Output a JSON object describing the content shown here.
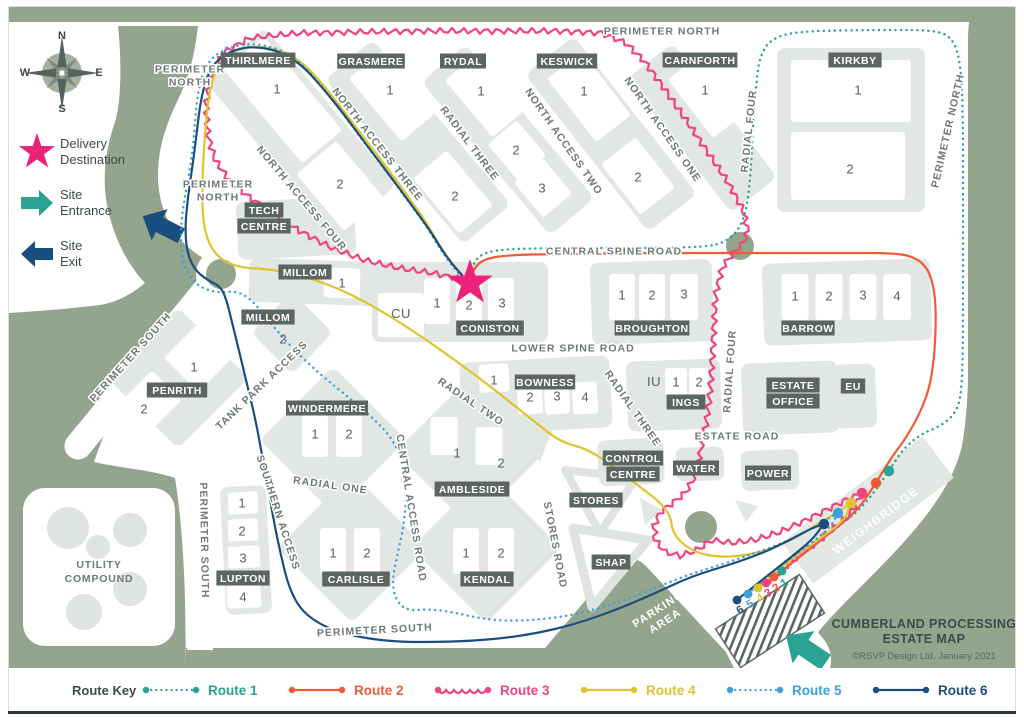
{
  "window": {
    "title_line1": "CUMBERLAND PROCESSING",
    "title_line2": "ESTATE MAP",
    "copyright": "©RSVP Design Ltd.  January 2021"
  },
  "compass": {
    "north": "N",
    "east": "E",
    "south": "S",
    "west": "W"
  },
  "legend": {
    "delivery": {
      "line1": "Delivery",
      "line2": "Destination"
    },
    "entrance": {
      "line1": "Site",
      "line2": "Entrance"
    },
    "exit": {
      "line1": "Site",
      "line2": "Exit"
    }
  },
  "route_key": {
    "title": "Route Key",
    "routes": [
      {
        "id": "route1",
        "label": "Route 1",
        "color": "#29A294",
        "style": "dotted"
      },
      {
        "id": "route2",
        "label": "Route 2",
        "color": "#F05A38",
        "style": "solid"
      },
      {
        "id": "route3",
        "label": "Route 3",
        "color": "#F0437F",
        "style": "wavy"
      },
      {
        "id": "route4",
        "label": "Route 4",
        "color": "#DFC32F",
        "style": "solid"
      },
      {
        "id": "route5",
        "label": "Route 5",
        "color": "#3BA0DC",
        "style": "dotted"
      },
      {
        "id": "route6",
        "label": "Route 6",
        "color": "#1C4E7D",
        "style": "solid"
      }
    ]
  },
  "map": {
    "buildings": {
      "thirlmere": {
        "label": "THIRLMERE",
        "units": [
          "1",
          "2"
        ]
      },
      "grasmere": {
        "label": "GRASMERE",
        "units": [
          "1",
          "2"
        ]
      },
      "rydal": {
        "label": "RYDAL",
        "units": [
          "1",
          "2",
          "3"
        ]
      },
      "keswick": {
        "label": "KESWICK",
        "units": [
          "1",
          "2"
        ]
      },
      "carnforth": {
        "label": "CARNFORTH",
        "units": [
          "1"
        ]
      },
      "kirkby": {
        "label": "KIRKBY",
        "units": [
          "1",
          "2"
        ]
      },
      "tech_centre": {
        "label": "TECH CENTRE",
        "units": []
      },
      "millom_1": {
        "label": "MILLOM",
        "units": [
          "1"
        ]
      },
      "millom_2": {
        "label": "MILLOM",
        "units": [
          "2"
        ]
      },
      "coniston": {
        "label": "CONISTON",
        "units": [
          "1",
          "2",
          "3"
        ]
      },
      "broughton": {
        "label": "BROUGHTON",
        "units": [
          "1",
          "2",
          "3"
        ]
      },
      "barrow": {
        "label": "BARROW",
        "units": [
          "1",
          "2",
          "3",
          "4"
        ]
      },
      "penrith": {
        "label": "PENRITH",
        "units": [
          "1",
          "2"
        ]
      },
      "windermere": {
        "label": "WINDERMERE",
        "units": [
          "1",
          "2"
        ]
      },
      "bowness": {
        "label": "BOWNESS",
        "units": [
          "1",
          "2",
          "3",
          "4"
        ]
      },
      "ings": {
        "label": "INGS",
        "units": [
          "1",
          "2"
        ]
      },
      "estate_office": {
        "label": "ESTATE OFFICE",
        "units": []
      },
      "eu": {
        "label": "EU",
        "units": []
      },
      "control_centre": {
        "label": "CONTROL CENTRE",
        "units": []
      },
      "water": {
        "label": "WATER",
        "units": []
      },
      "power": {
        "label": "POWER",
        "units": []
      },
      "ambleside": {
        "label": "AMBLESIDE",
        "units": [
          "1",
          "2"
        ]
      },
      "stores": {
        "label": "STORES",
        "units": []
      },
      "shap": {
        "label": "SHAP",
        "units": []
      },
      "carlisle": {
        "label": "CARLISLE",
        "units": [
          "1",
          "2"
        ]
      },
      "kendal": {
        "label": "KENDAL",
        "units": [
          "1",
          "2"
        ]
      },
      "lupton": {
        "label": "LUPTON",
        "units": [
          "1",
          "2",
          "3",
          "4"
        ]
      }
    },
    "areas": {
      "cu": "CU",
      "iu": "IU",
      "utility_compound": {
        "line1": "UTILITY",
        "line2": "COMPOUND"
      },
      "parking_area": {
        "line1": "PARKING",
        "line2": "AREA"
      },
      "weighbridge": "WEIGHBRIDGE"
    },
    "roads": {
      "perimeter_north": "PERIMETER NORTH",
      "perimeter_south": "PERIMETER SOUTH",
      "north_access_one": "NORTH ACCESS ONE",
      "north_access_two": "NORTH ACCESS TWO",
      "north_access_three": "NORTH ACCESS THREE",
      "north_access_four": "NORTH ACCESS FOUR",
      "radial_one": "RADIAL ONE",
      "radial_two": "RADIAL TWO",
      "radial_three": "RADIAL THREE",
      "radial_four": "RADIAL FOUR",
      "central_spine_road": "CENTRAL SPINE ROAD",
      "lower_spine_road": "LOWER SPINE ROAD",
      "estate_road": "ESTATE ROAD",
      "tank_park_access": "TANK PARK ACCESS",
      "southern_access": "SOUTHERN ACCESS",
      "central_access_road": "CENTRAL ACCESS ROAD",
      "stores_road": "STORES ROAD"
    },
    "markers": {
      "entrance_numbers": [
        "6",
        "5",
        "4",
        "3",
        "2",
        "1"
      ]
    }
  },
  "colors": {
    "green": "#93A58D",
    "block_gray": "#E2E7E3",
    "cell_white": "#FFFFFF",
    "chip": "#5A665F",
    "road_text": "#6E7974",
    "dark_text": "#3D4A46",
    "star_pink": "#EC2179",
    "entrance_teal": "#2BA392",
    "exit_navy": "#174E7E"
  }
}
